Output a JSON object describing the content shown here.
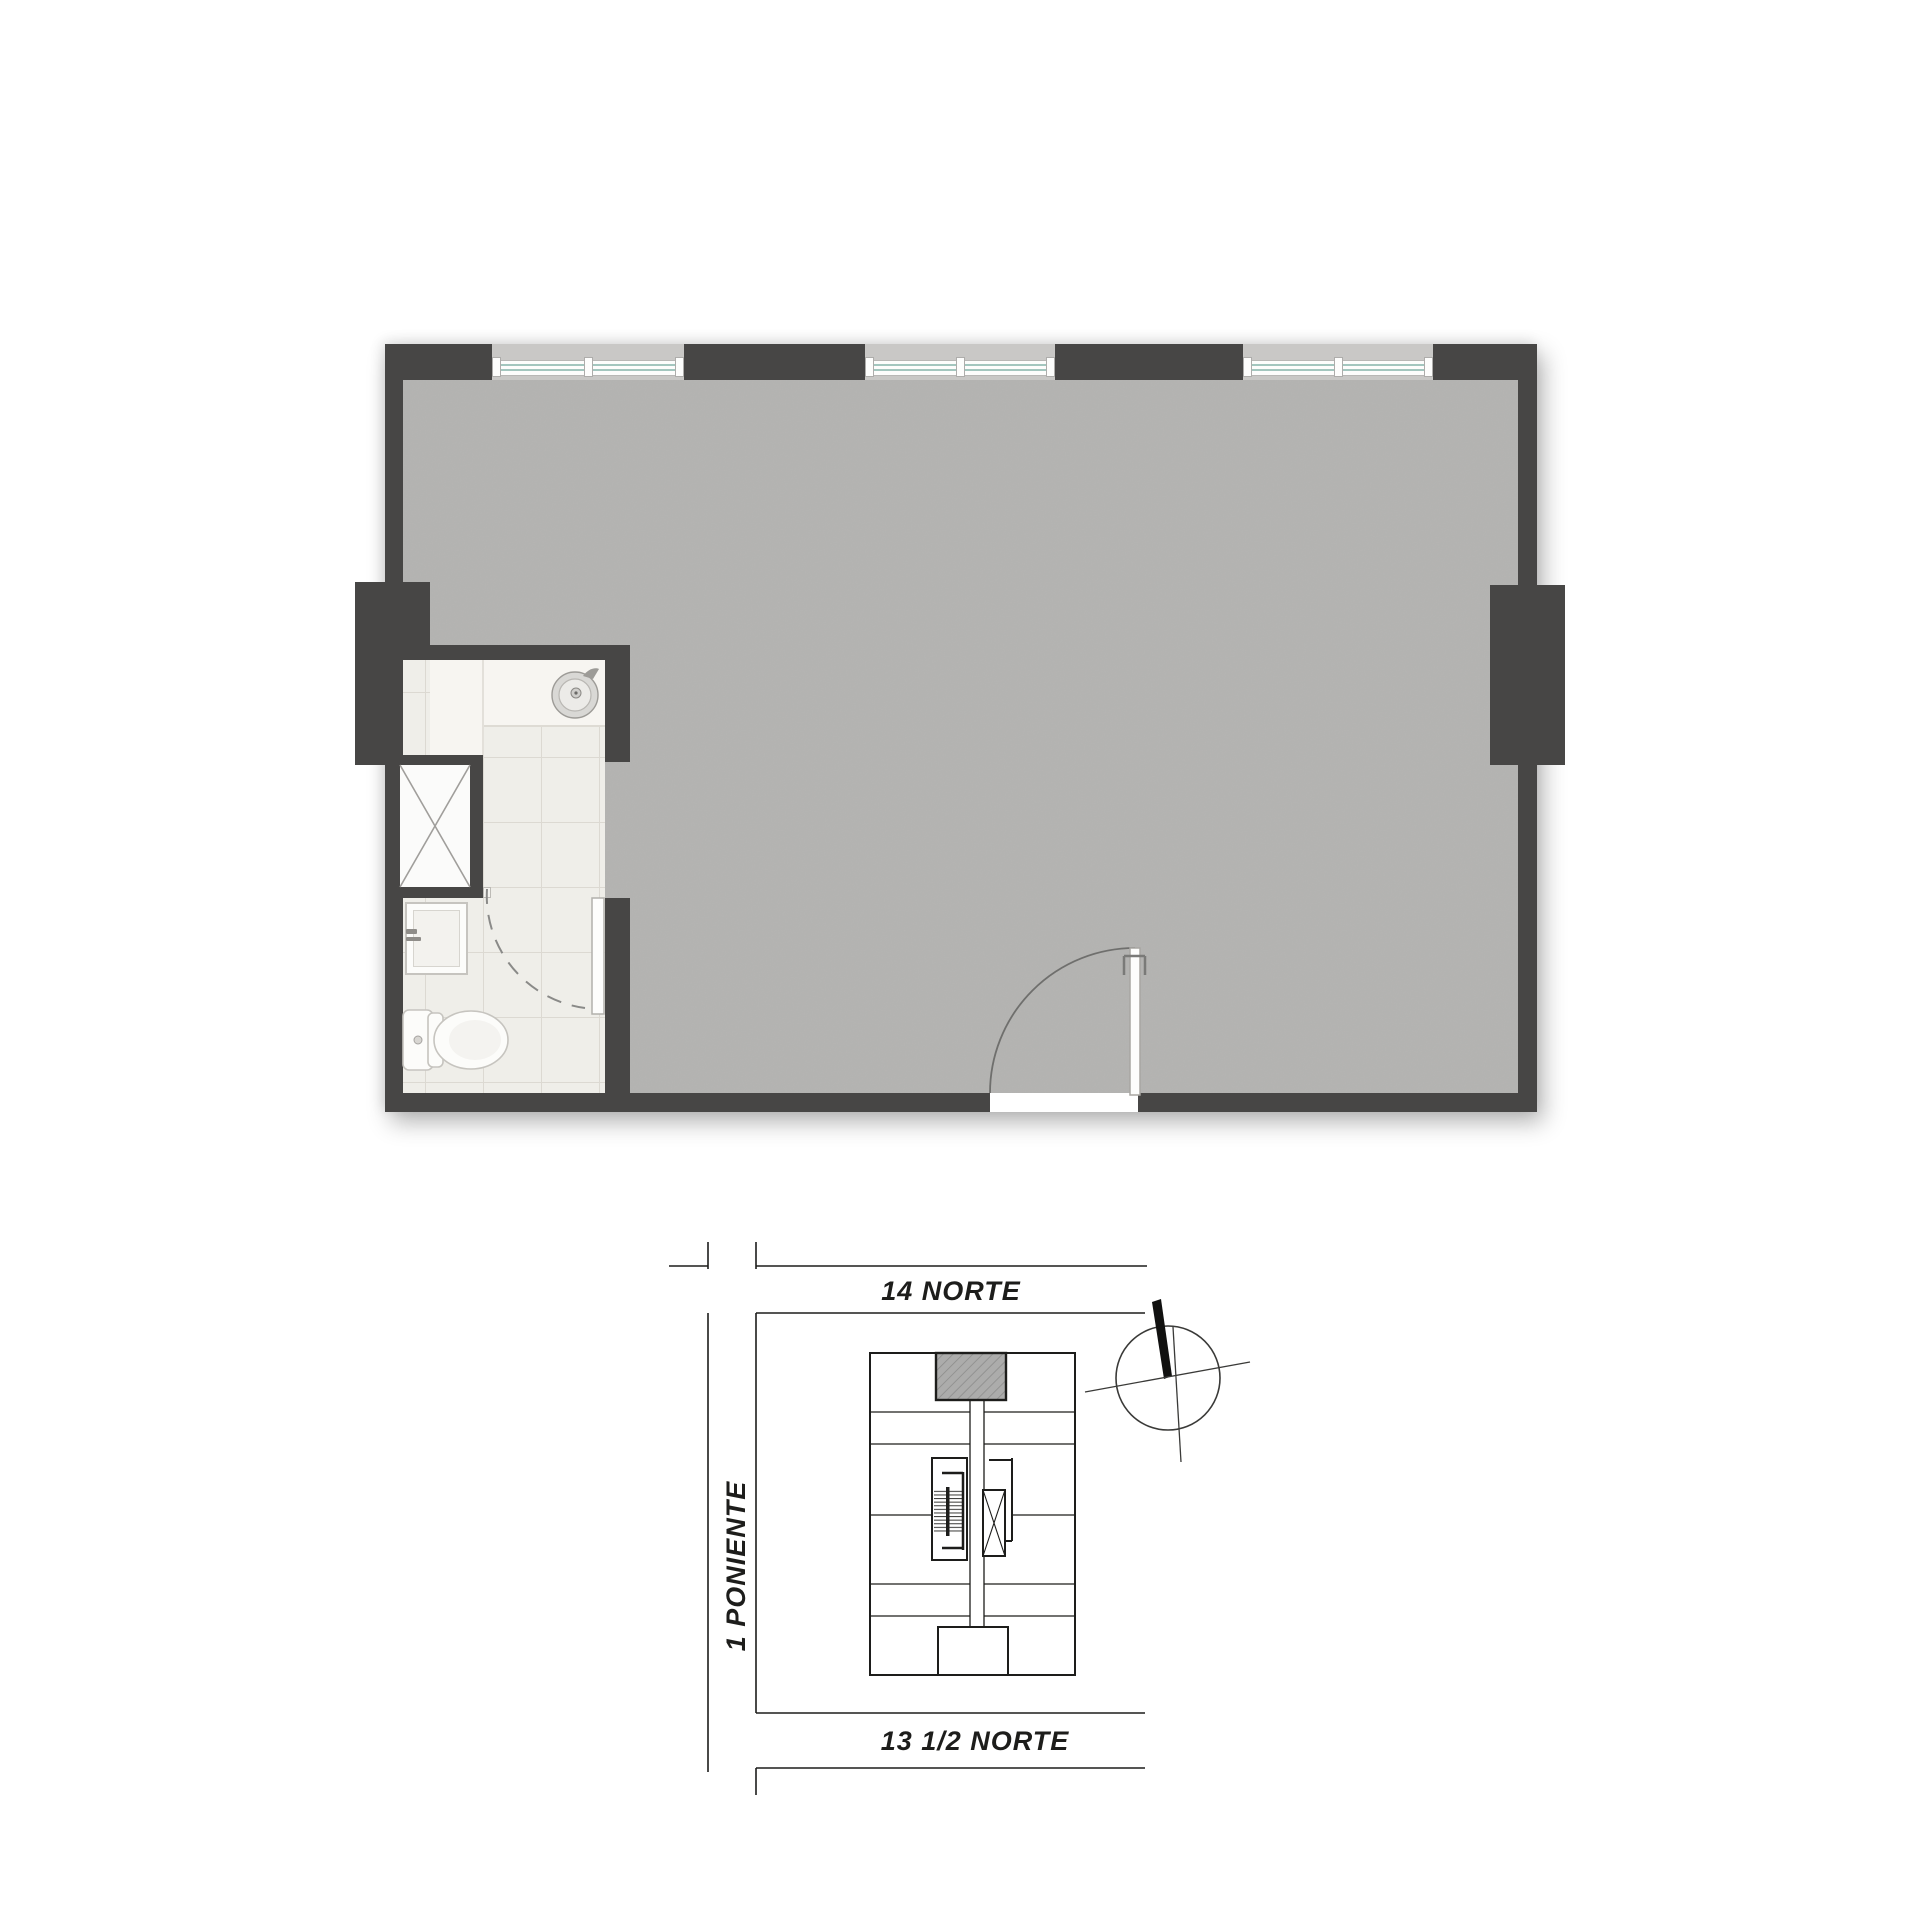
{
  "page": {
    "background": "#ffffff",
    "kind": "apartment floor plan with site location diagram"
  },
  "colors": {
    "wall": "#474645",
    "floor": "#b9b8b6",
    "win_surround": "#c9c8c6",
    "glass_line": "#a3c6be",
    "tile": "#efeee9",
    "tile_line": "#dcd9d2",
    "counter": "#f7f5f1",
    "fixture": "#fcfcfa",
    "fixture_line": "#c6c4bf",
    "ink": "#1d1d1b",
    "hatch": "#acacab"
  },
  "floor_plan": {
    "fixtures": [
      "round-sink",
      "shower-tray",
      "toilet",
      "duct-shaft-x",
      "bathroom-door",
      "entry-door"
    ],
    "window_count": 3
  },
  "site_plan": {
    "streets": {
      "top": "14 NORTE",
      "left": "1 PONIENTE",
      "bottom": "13 1/2 NORTE"
    },
    "compass_icon": "north-arrow-icon",
    "unit_highlight": "hatched-unit-top-center"
  }
}
